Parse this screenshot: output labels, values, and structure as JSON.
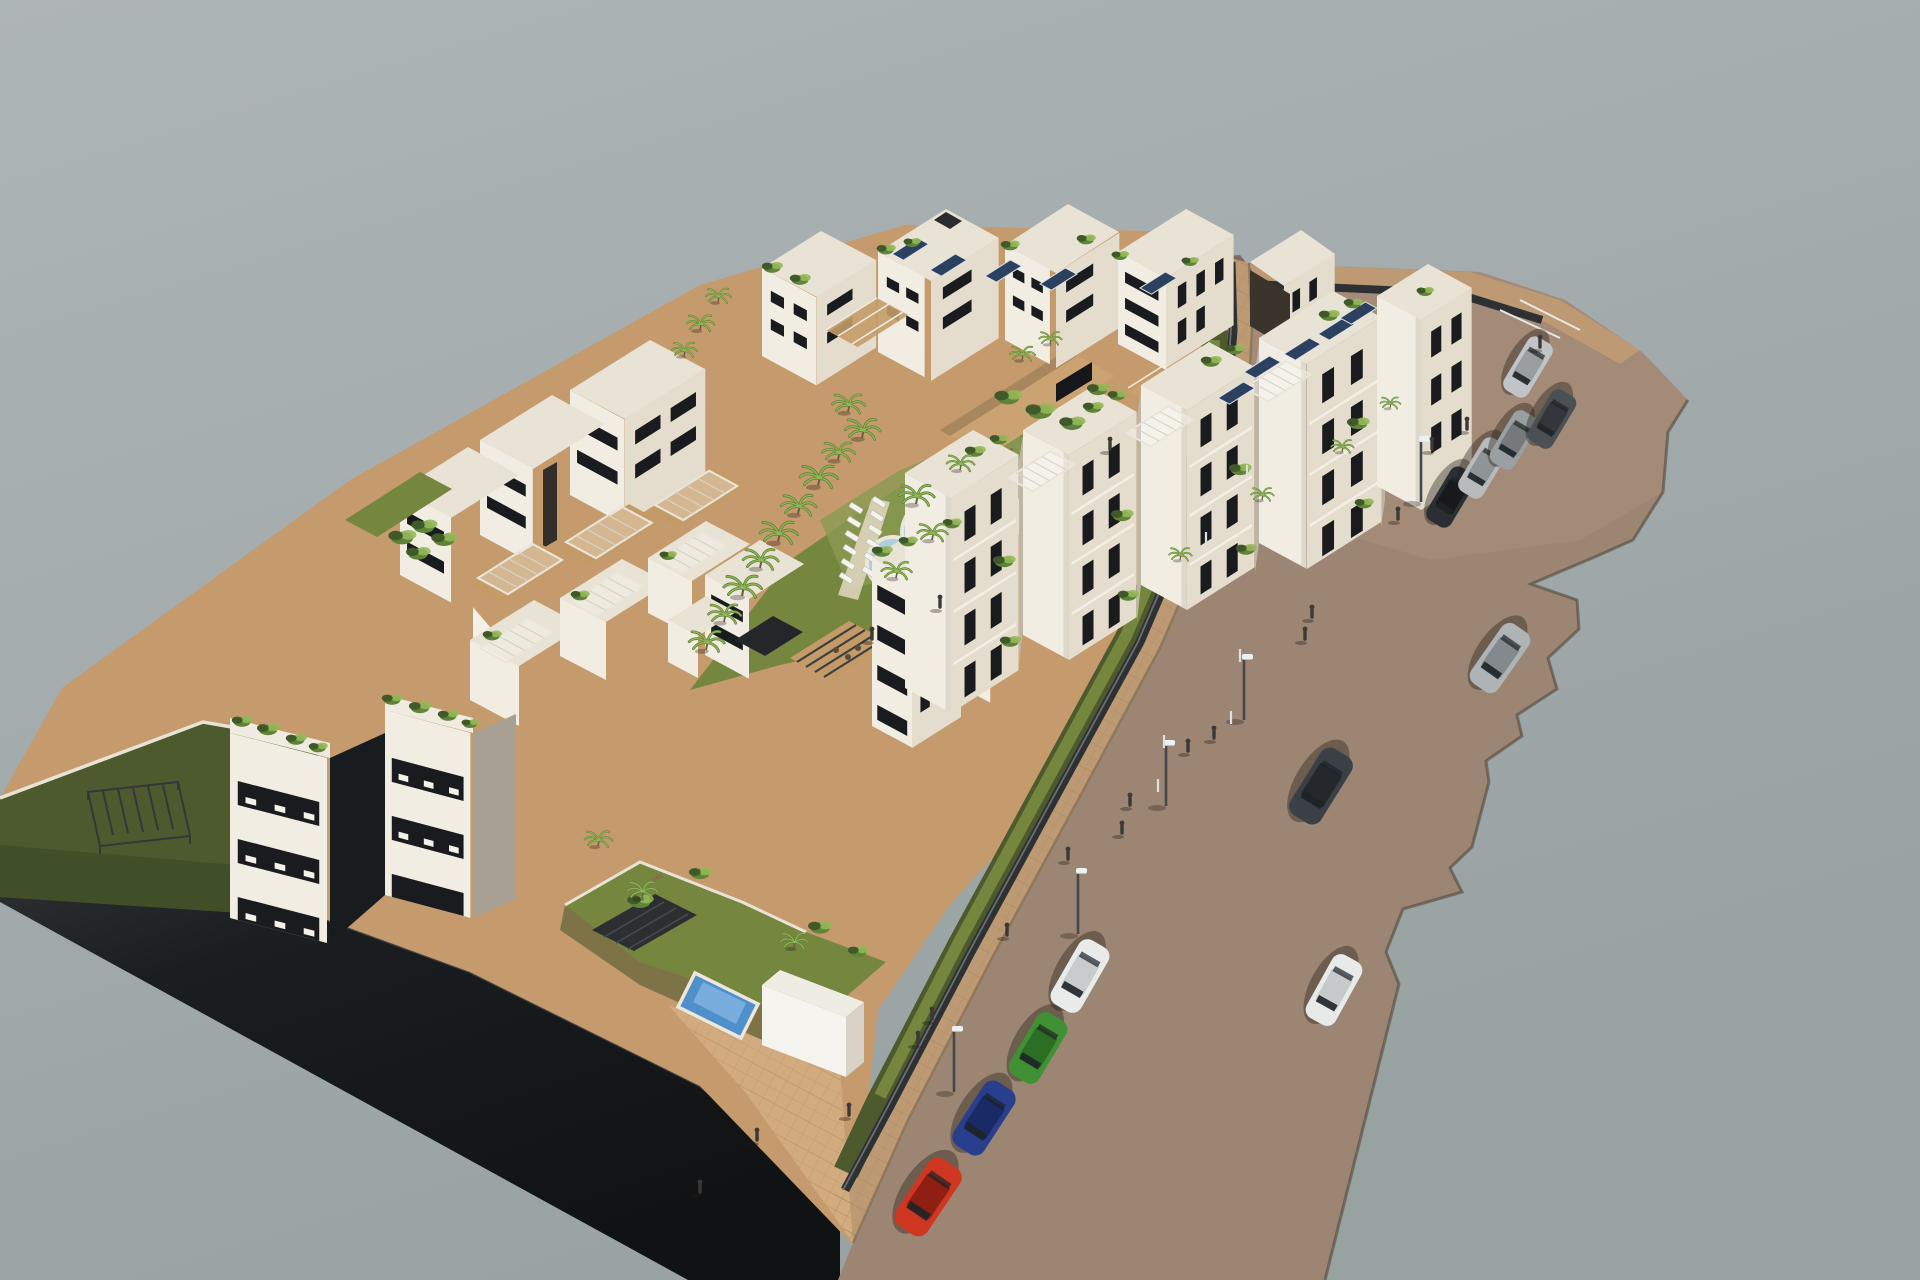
{
  "scene": {
    "description": "Aerial 3D architectural rendering of a new-build residential apartment complex with rooftop terraces, solar panels, communal pool with sun loungers, private gardens with small pools, and a street with parked and moving cars, streetlights and pedestrians, on a plain gray background",
    "background": {
      "top": "#aeb5b7",
      "mid": "#a4acae",
      "bottom": "#98a2a1"
    },
    "palette": {
      "base": "#c59a6c",
      "road": "#9c8673",
      "roadTop": "#a98f7b",
      "sidewalk": "#bd9a73",
      "sidewalkLight": "#d2ab7e",
      "court": "#cba271",
      "curb": "#8d7458",
      "darkBand": "#17191b",
      "darkBand2": "#2e3234",
      "lawn": "#75863f",
      "lawnBright": "#8a9a52",
      "lawnDark": "#4d5a2e",
      "lawnShade": "#3f4c28",
      "tree": "#5f8338",
      "treeLight": "#93b858",
      "treeDark": "#3f5a28",
      "white": "#f1ede3",
      "cream": "#e4ddcd",
      "roofLight": "#e9e3d5",
      "shade": "#cfc8ba",
      "shadeDark": "#a8a092",
      "win": "#191b1e",
      "wall": "#2e3133",
      "wood": "#c49b66",
      "woodDark": "#8a6f4b",
      "pergola": "#e9e5da",
      "pergolaDark": "#2c2f31",
      "solar": "#2c4160",
      "solarFrame": "#dfe3e6",
      "poolBig": "#aecfdb",
      "poolDeep": "#8fb9cb",
      "poolRim": "#ece7da",
      "poolSmall": "#4f8fcb",
      "glass": "#1d2327",
      "lamp": "#45484a",
      "lampHead": "#eef1f2",
      "person": "#3b3835"
    },
    "cars": [
      {
        "name": "red-hatchback-parked",
        "x": 928,
        "y": 1197,
        "angle": 124,
        "length": 80,
        "width": 38,
        "body": "#d03722",
        "roof": "#8f1f12"
      },
      {
        "name": "blue-sedan-parked",
        "x": 984,
        "y": 1118,
        "angle": 123,
        "length": 76,
        "width": 36,
        "body": "#2a3e8e",
        "roof": "#1a2a66"
      },
      {
        "name": "green-hatchback-parked",
        "x": 1038,
        "y": 1048,
        "angle": 121,
        "length": 72,
        "width": 34,
        "body": "#3f9134",
        "roof": "#2c6e24"
      },
      {
        "name": "white-pickup-parked",
        "x": 1080,
        "y": 976,
        "angle": 120,
        "length": 74,
        "width": 34,
        "body": "#e9ebeb",
        "roof": "#c8cccc"
      },
      {
        "name": "black-car-parked",
        "x": 1451,
        "y": 497,
        "angle": 121,
        "length": 62,
        "width": 28,
        "body": "#2b2f33",
        "roof": "#17191c"
      },
      {
        "name": "silver-car-parked",
        "x": 1483,
        "y": 468,
        "angle": 121,
        "length": 62,
        "width": 28,
        "body": "#b7bbbc",
        "roof": "#8f9496"
      },
      {
        "name": "gray-car-parked",
        "x": 1514,
        "y": 440,
        "angle": 121,
        "length": 60,
        "width": 28,
        "body": "#9aa0a2",
        "roof": "#75797c"
      },
      {
        "name": "darkgray-car-parked",
        "x": 1552,
        "y": 419,
        "angle": 121,
        "length": 60,
        "width": 28,
        "body": "#4a5054",
        "roof": "#33373b"
      },
      {
        "name": "silver-car-parked-top",
        "x": 1528,
        "y": 367,
        "angle": 121,
        "length": 62,
        "width": 28,
        "body": "#c0c4c6",
        "roof": "#999ea0"
      },
      {
        "name": "silver-hatch-driving",
        "x": 1500,
        "y": 658,
        "angle": 125,
        "length": 72,
        "width": 33,
        "body": "#aeb3b5",
        "roof": "#83898c"
      },
      {
        "name": "dark-suv-driving",
        "x": 1321,
        "y": 786,
        "angle": 122,
        "length": 78,
        "width": 36,
        "body": "#3a4046",
        "roof": "#24282c"
      },
      {
        "name": "white-car-driving",
        "x": 1334,
        "y": 990,
        "angle": 119,
        "length": 72,
        "width": 33,
        "body": "#e8eaea",
        "roof": "#c6caca"
      }
    ],
    "street_lamps": [
      {
        "x": 1078,
        "y": 934
      },
      {
        "x": 954,
        "y": 1092
      },
      {
        "x": 1166,
        "y": 806
      },
      {
        "x": 1244,
        "y": 720
      },
      {
        "x": 1421,
        "y": 502
      }
    ],
    "bollards": [
      {
        "x": 1240,
        "y": 662
      },
      {
        "x": 1231,
        "y": 724
      },
      {
        "x": 1164,
        "y": 748
      },
      {
        "x": 1158,
        "y": 792
      },
      {
        "x": 1206,
        "y": 545
      },
      {
        "x": 1247,
        "y": 478
      }
    ],
    "people": [
      {
        "x": 932,
        "y": 1022
      },
      {
        "x": 918,
        "y": 1046
      },
      {
        "x": 849,
        "y": 1118
      },
      {
        "x": 757,
        "y": 1143
      },
      {
        "x": 700,
        "y": 1195
      },
      {
        "x": 1007,
        "y": 938
      },
      {
        "x": 1068,
        "y": 862
      },
      {
        "x": 1122,
        "y": 836
      },
      {
        "x": 1130,
        "y": 808
      },
      {
        "x": 1188,
        "y": 754
      },
      {
        "x": 1214,
        "y": 741
      },
      {
        "x": 1305,
        "y": 642
      },
      {
        "x": 1312,
        "y": 620
      },
      {
        "x": 1398,
        "y": 522
      },
      {
        "x": 1432,
        "y": 452
      },
      {
        "x": 1467,
        "y": 432
      },
      {
        "x": 1540,
        "y": 350
      },
      {
        "x": 1110,
        "y": 452
      },
      {
        "x": 872,
        "y": 642
      },
      {
        "x": 940,
        "y": 610
      }
    ],
    "palms": [
      {
        "x": 848,
        "y": 412,
        "s": 1.3
      },
      {
        "x": 862,
        "y": 438,
        "s": 1.4
      },
      {
        "x": 838,
        "y": 460,
        "s": 1.3
      },
      {
        "x": 818,
        "y": 486,
        "s": 1.5
      },
      {
        "x": 798,
        "y": 514,
        "s": 1.4
      },
      {
        "x": 778,
        "y": 542,
        "s": 1.5
      },
      {
        "x": 760,
        "y": 568,
        "s": 1.4
      },
      {
        "x": 742,
        "y": 596,
        "s": 1.5
      },
      {
        "x": 724,
        "y": 622,
        "s": 1.3
      },
      {
        "x": 706,
        "y": 650,
        "s": 1.4
      },
      {
        "x": 916,
        "y": 504,
        "s": 1.4
      },
      {
        "x": 932,
        "y": 540,
        "s": 1.2
      },
      {
        "x": 896,
        "y": 578,
        "s": 1.2
      },
      {
        "x": 960,
        "y": 470,
        "s": 1.1
      },
      {
        "x": 598,
        "y": 846,
        "s": 1.1
      },
      {
        "x": 642,
        "y": 898,
        "s": 1.2
      },
      {
        "x": 794,
        "y": 948,
        "s": 1.1
      },
      {
        "x": 700,
        "y": 330,
        "s": 1.1
      },
      {
        "x": 718,
        "y": 302,
        "s": 1.0
      },
      {
        "x": 684,
        "y": 356,
        "s": 1.0
      },
      {
        "x": 1180,
        "y": 560,
        "s": 0.9
      },
      {
        "x": 1262,
        "y": 500,
        "s": 0.9
      },
      {
        "x": 1342,
        "y": 452,
        "s": 0.9
      },
      {
        "x": 1390,
        "y": 408,
        "s": 0.8
      },
      {
        "x": 1022,
        "y": 360,
        "s": 1.0
      },
      {
        "x": 1050,
        "y": 344,
        "s": 0.9
      }
    ],
    "shrubs": [
      {
        "x": 242,
        "y": 722,
        "s": 1.2
      },
      {
        "x": 268,
        "y": 730,
        "s": 1.3
      },
      {
        "x": 296,
        "y": 740,
        "s": 1.2
      },
      {
        "x": 318,
        "y": 748,
        "s": 1.1
      },
      {
        "x": 392,
        "y": 700,
        "s": 1.2
      },
      {
        "x": 420,
        "y": 708,
        "s": 1.3
      },
      {
        "x": 448,
        "y": 716,
        "s": 1.2
      },
      {
        "x": 470,
        "y": 724,
        "s": 1.0
      },
      {
        "x": 402,
        "y": 538,
        "s": 1.6
      },
      {
        "x": 424,
        "y": 527,
        "s": 1.5
      },
      {
        "x": 444,
        "y": 540,
        "s": 1.5
      },
      {
        "x": 418,
        "y": 554,
        "s": 1.4
      },
      {
        "x": 772,
        "y": 268,
        "s": 1.2
      },
      {
        "x": 800,
        "y": 280,
        "s": 1.2
      },
      {
        "x": 886,
        "y": 250,
        "s": 1.1
      },
      {
        "x": 912,
        "y": 243,
        "s": 1.0
      },
      {
        "x": 1010,
        "y": 246,
        "s": 1.1
      },
      {
        "x": 1086,
        "y": 240,
        "s": 1.1
      },
      {
        "x": 1120,
        "y": 256,
        "s": 1.0
      },
      {
        "x": 1190,
        "y": 262,
        "s": 1.0
      },
      {
        "x": 1008,
        "y": 398,
        "s": 1.6
      },
      {
        "x": 1040,
        "y": 412,
        "s": 1.7
      },
      {
        "x": 1072,
        "y": 424,
        "s": 1.5
      },
      {
        "x": 1098,
        "y": 390,
        "s": 1.3
      },
      {
        "x": 975,
        "y": 452,
        "s": 1.2
      },
      {
        "x": 999,
        "y": 440,
        "s": 1.1
      },
      {
        "x": 1093,
        "y": 408,
        "s": 1.2
      },
      {
        "x": 1117,
        "y": 396,
        "s": 1.1
      },
      {
        "x": 1211,
        "y": 362,
        "s": 1.2
      },
      {
        "x": 1235,
        "y": 350,
        "s": 1.1
      },
      {
        "x": 1329,
        "y": 316,
        "s": 1.2
      },
      {
        "x": 1353,
        "y": 304,
        "s": 1.1
      },
      {
        "x": 1425,
        "y": 292,
        "s": 1.0
      },
      {
        "x": 1004,
        "y": 562,
        "s": 1.3
      },
      {
        "x": 1010,
        "y": 642,
        "s": 1.2
      },
      {
        "x": 1122,
        "y": 516,
        "s": 1.3
      },
      {
        "x": 1128,
        "y": 596,
        "s": 1.2
      },
      {
        "x": 1240,
        "y": 470,
        "s": 1.3
      },
      {
        "x": 1246,
        "y": 550,
        "s": 1.2
      },
      {
        "x": 1358,
        "y": 424,
        "s": 1.3
      },
      {
        "x": 1364,
        "y": 504,
        "s": 1.1
      },
      {
        "x": 882,
        "y": 552,
        "s": 1.2
      },
      {
        "x": 908,
        "y": 542,
        "s": 1.1
      },
      {
        "x": 952,
        "y": 524,
        "s": 1.1
      },
      {
        "x": 640,
        "y": 902,
        "s": 1.5
      },
      {
        "x": 700,
        "y": 874,
        "s": 1.3
      },
      {
        "x": 820,
        "y": 928,
        "s": 1.4
      },
      {
        "x": 858,
        "y": 952,
        "s": 1.2
      },
      {
        "x": 492,
        "y": 636,
        "s": 1.1
      },
      {
        "x": 580,
        "y": 596,
        "s": 1.1
      },
      {
        "x": 668,
        "y": 556,
        "s": 1.0
      }
    ],
    "loungers": [
      {
        "x": 846,
        "y": 578
      },
      {
        "x": 848,
        "y": 564
      },
      {
        "x": 850,
        "y": 550
      },
      {
        "x": 852,
        "y": 536
      },
      {
        "x": 854,
        "y": 522
      },
      {
        "x": 856,
        "y": 508
      },
      {
        "x": 869,
        "y": 572
      },
      {
        "x": 871,
        "y": 558
      },
      {
        "x": 873,
        "y": 544
      },
      {
        "x": 875,
        "y": 530
      },
      {
        "x": 877,
        "y": 516
      },
      {
        "x": 879,
        "y": 502
      }
    ],
    "solar_panels": [
      {
        "x": 892,
        "y": 254
      },
      {
        "x": 930,
        "y": 270
      },
      {
        "x": 985,
        "y": 276
      },
      {
        "x": 1040,
        "y": 284
      },
      {
        "x": 1140,
        "y": 288
      },
      {
        "x": 1218,
        "y": 398
      },
      {
        "x": 1244,
        "y": 372
      },
      {
        "x": 1284,
        "y": 354
      },
      {
        "x": 1318,
        "y": 334
      },
      {
        "x": 1340,
        "y": 318
      }
    ],
    "swimmers": [
      {
        "x": 886,
        "y": 560,
        "c": "#e08a4a"
      },
      {
        "x": 897,
        "y": 567,
        "c": "#e0c04a"
      },
      {
        "x": 907,
        "y": 556,
        "c": "#cf6a3c"
      }
    ]
  }
}
